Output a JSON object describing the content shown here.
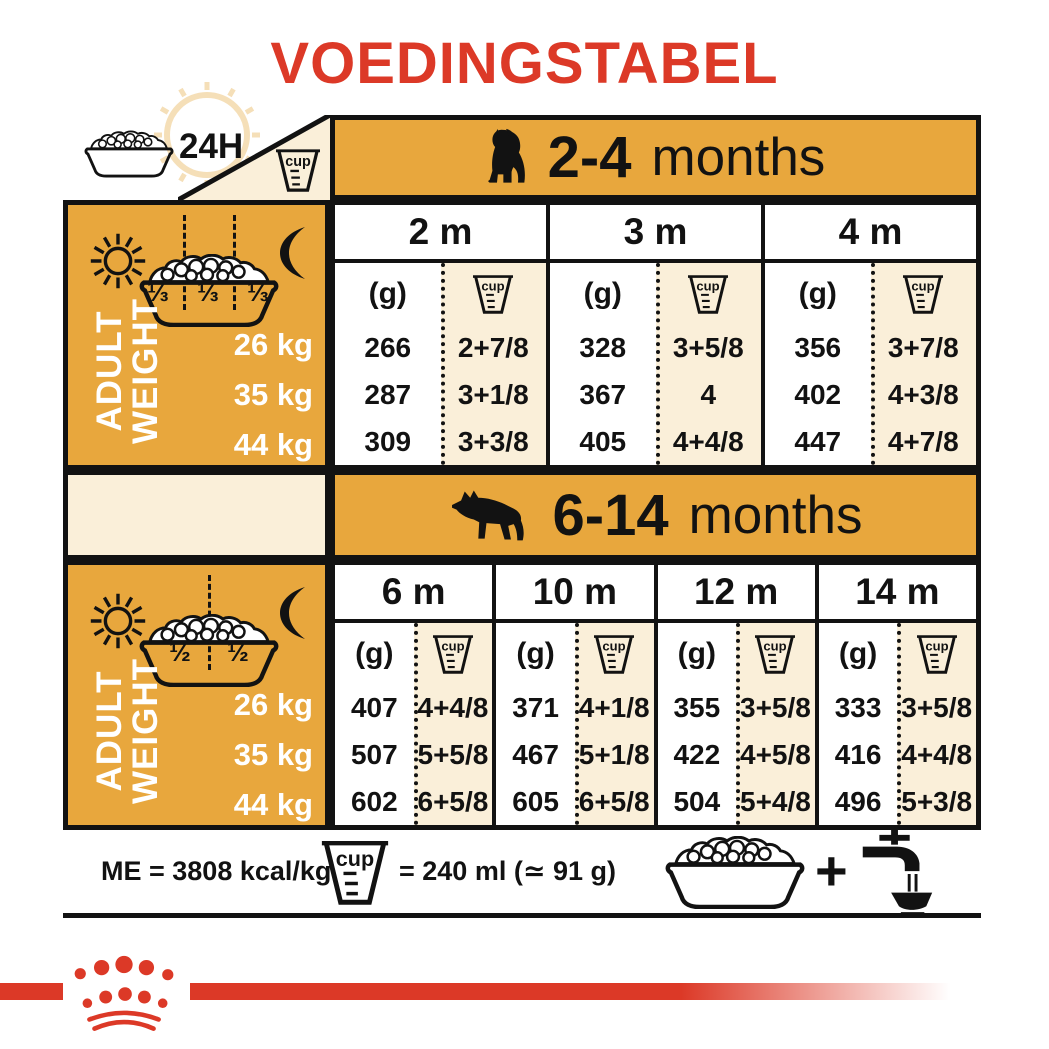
{
  "title": "VOEDINGSTABEL",
  "legend": {
    "hours_label": "24H",
    "cup_label": "cup"
  },
  "sections": [
    {
      "age_range": "2-4",
      "age_word": "months",
      "dog_icon": "puppy-silhouette-icon",
      "meal_portions": [
        "⅓",
        "⅓",
        "⅓"
      ],
      "row_label_lines": [
        "ADULT",
        "WEIGHT"
      ],
      "weights": [
        "26 kg",
        "35 kg",
        "44 kg"
      ],
      "grams_unit": "(g)",
      "columns": [
        {
          "month": "2 m",
          "rows": [
            {
              "g": "266",
              "cups": "2+7/8"
            },
            {
              "g": "287",
              "cups": "3+1/8"
            },
            {
              "g": "309",
              "cups": "3+3/8"
            }
          ]
        },
        {
          "month": "3 m",
          "rows": [
            {
              "g": "328",
              "cups": "3+5/8"
            },
            {
              "g": "367",
              "cups": "4"
            },
            {
              "g": "405",
              "cups": "4+4/8"
            }
          ]
        },
        {
          "month": "4 m",
          "rows": [
            {
              "g": "356",
              "cups": "3+7/8"
            },
            {
              "g": "402",
              "cups": "4+3/8"
            },
            {
              "g": "447",
              "cups": "4+7/8"
            }
          ]
        }
      ]
    },
    {
      "age_range": "6-14",
      "age_word": "months",
      "dog_icon": "adult-dog-silhouette-icon",
      "meal_portions": [
        "½",
        "½"
      ],
      "row_label_lines": [
        "ADULT",
        "WEIGHT"
      ],
      "weights": [
        "26 kg",
        "35 kg",
        "44 kg"
      ],
      "grams_unit": "(g)",
      "columns": [
        {
          "month": "6 m",
          "rows": [
            {
              "g": "407",
              "cups": "4+4/8"
            },
            {
              "g": "507",
              "cups": "5+5/8"
            },
            {
              "g": "602",
              "cups": "6+5/8"
            }
          ]
        },
        {
          "month": "10 m",
          "rows": [
            {
              "g": "371",
              "cups": "4+1/8"
            },
            {
              "g": "467",
              "cups": "5+1/8"
            },
            {
              "g": "605",
              "cups": "6+5/8"
            }
          ]
        },
        {
          "month": "12 m",
          "rows": [
            {
              "g": "355",
              "cups": "3+5/8"
            },
            {
              "g": "422",
              "cups": "4+5/8"
            },
            {
              "g": "504",
              "cups": "5+4/8"
            }
          ]
        },
        {
          "month": "14 m",
          "rows": [
            {
              "g": "333",
              "cups": "3+5/8"
            },
            {
              "g": "416",
              "cups": "4+4/8"
            },
            {
              "g": "496",
              "cups": "5+3/8"
            }
          ]
        }
      ]
    }
  ],
  "footer": {
    "energy": "ME = 3808 kcal/kg",
    "cup_equivalence": "= 240 ml (≃ 91 g)",
    "plus_sign": "+"
  },
  "colors": {
    "gold": "#E8A73D",
    "cream": "#FAEFD9",
    "red": "#DC3927",
    "ink": "#121212"
  },
  "icons": {
    "top_left": [
      "food-bowl-icon",
      "24h-clock-icon",
      "measuring-cup-icon"
    ],
    "panels": [
      "sun-icon",
      "food-bowl-icon",
      "moon-icon"
    ],
    "footer": [
      "measuring-cup-icon",
      "food-bowl-icon",
      "plus-sign",
      "water-tap-icon"
    ],
    "brand": "royal-canin-crown-logo"
  }
}
